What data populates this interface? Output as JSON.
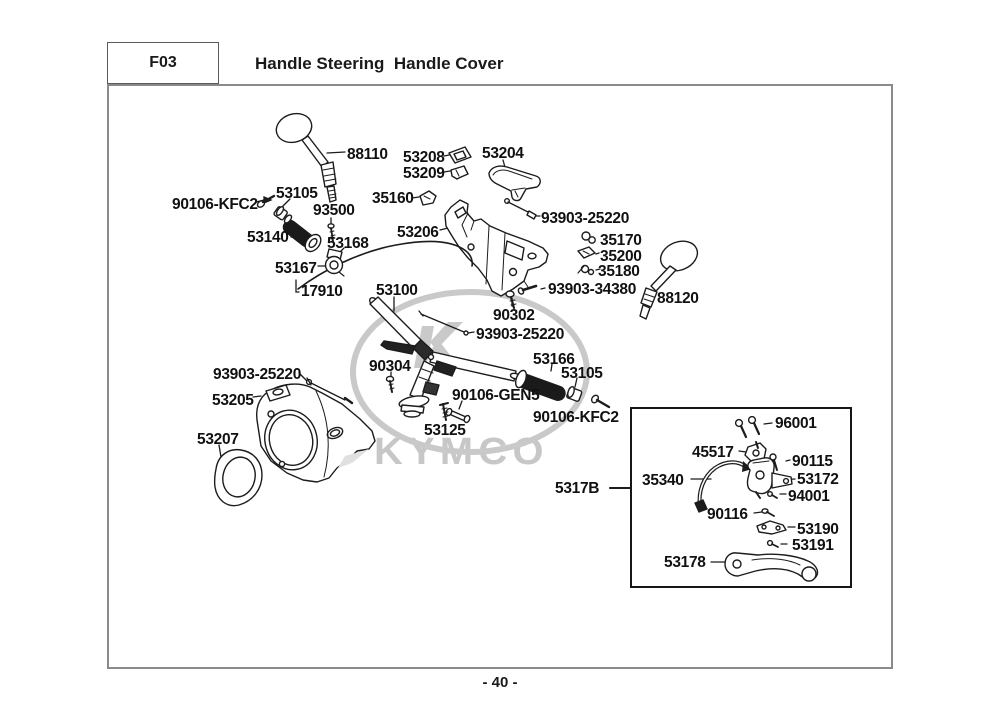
{
  "page": {
    "header": {
      "section_code": "F03",
      "title": "Handle Steering  Handle Cover"
    },
    "footer": {
      "page_number": "- 40 -"
    },
    "watermark": {
      "brand": "KYMCO"
    }
  },
  "colors": {
    "line": "#1c1c1c",
    "outer_border": "#8a8a8a",
    "subassembly_border": "#161616",
    "watermark": "#c7c7c7",
    "label_text": "#111111"
  },
  "diagram": {
    "part_labels": [
      {
        "text": "88110",
        "x": 347,
        "y": 146
      },
      {
        "text": "53208",
        "x": 403,
        "y": 149
      },
      {
        "text": "53209",
        "x": 403,
        "y": 165
      },
      {
        "text": "53204",
        "x": 482,
        "y": 145
      },
      {
        "text": "90106-KFC2",
        "x": 172,
        "y": 196
      },
      {
        "text": "53105",
        "x": 276,
        "y": 185
      },
      {
        "text": "93500",
        "x": 313,
        "y": 202
      },
      {
        "text": "35160",
        "x": 372,
        "y": 190
      },
      {
        "text": "93903-25220",
        "x": 541,
        "y": 210
      },
      {
        "text": "53140",
        "x": 247,
        "y": 229
      },
      {
        "text": "53168",
        "x": 327,
        "y": 235
      },
      {
        "text": "53206",
        "x": 397,
        "y": 224
      },
      {
        "text": "35170",
        "x": 600,
        "y": 232
      },
      {
        "text": "35200",
        "x": 600,
        "y": 248
      },
      {
        "text": "35180",
        "x": 598,
        "y": 263
      },
      {
        "text": "53167",
        "x": 275,
        "y": 260
      },
      {
        "text": "93903-34380",
        "x": 548,
        "y": 281
      },
      {
        "text": "17910",
        "x": 301,
        "y": 283
      },
      {
        "text": "53100",
        "x": 376,
        "y": 282
      },
      {
        "text": "88120",
        "x": 657,
        "y": 290
      },
      {
        "text": "90302",
        "x": 493,
        "y": 307
      },
      {
        "text": "93903-25220",
        "x": 476,
        "y": 326
      },
      {
        "text": "53166",
        "x": 533,
        "y": 351
      },
      {
        "text": "53105",
        "x": 561,
        "y": 365
      },
      {
        "text": "90304",
        "x": 369,
        "y": 358
      },
      {
        "text": "93903-25220",
        "x": 213,
        "y": 366
      },
      {
        "text": "53205",
        "x": 212,
        "y": 392
      },
      {
        "text": "90106-GEN5",
        "x": 452,
        "y": 387
      },
      {
        "text": "90106-KFC2",
        "x": 533,
        "y": 409
      },
      {
        "text": "53125",
        "x": 424,
        "y": 422
      },
      {
        "text": "53207",
        "x": 197,
        "y": 431
      },
      {
        "text": "5317B",
        "x": 555,
        "y": 480
      },
      {
        "text": "35340",
        "x": 642,
        "y": 472
      },
      {
        "text": "45517",
        "x": 692,
        "y": 444
      },
      {
        "text": "96001",
        "x": 775,
        "y": 415
      },
      {
        "text": "90115",
        "x": 792,
        "y": 453
      },
      {
        "text": "53172",
        "x": 797,
        "y": 471
      },
      {
        "text": "94001",
        "x": 788,
        "y": 488
      },
      {
        "text": "90116",
        "x": 707,
        "y": 506
      },
      {
        "text": "53190",
        "x": 797,
        "y": 521
      },
      {
        "text": "53191",
        "x": 792,
        "y": 537
      },
      {
        "text": "53178",
        "x": 664,
        "y": 554
      }
    ]
  }
}
